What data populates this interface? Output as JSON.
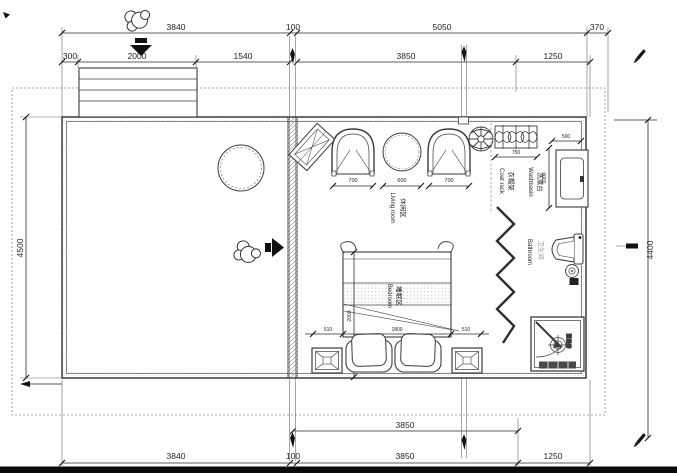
{
  "dimensions": {
    "top_row1": [
      "3840",
      "100",
      "5050",
      "370"
    ],
    "top_row2": [
      "300",
      "2000",
      "1540",
      "3850",
      "1250"
    ],
    "bottom_row1": [
      "3850"
    ],
    "bottom_row2": [
      "3840",
      "100",
      "3850",
      "1250"
    ],
    "left_height": "4500",
    "right_height": "4400",
    "living_row": [
      "700",
      "600",
      "700"
    ],
    "coat_rack_width": "750",
    "washbasin_width": "500",
    "washbasin_depth": "1000",
    "bed_row": [
      "510",
      "1800",
      "510"
    ],
    "bed_length": "2000"
  },
  "labels": {
    "living": {
      "zh": "休闲区",
      "en": "Living room"
    },
    "bedroom": {
      "zh": "睡眠区",
      "en": "Bedroom"
    },
    "washbasin": {
      "zh": "洗漱台",
      "en": "Washbasin"
    },
    "coat_rack": {
      "zh": "衣帽架",
      "en": "Coat rack"
    },
    "bathroom": {
      "zh": "卫生间",
      "en": "Bathroom"
    },
    "shower": {
      "zh": "淋浴房"
    }
  },
  "colors": {
    "line": "#3c3c3c",
    "text": "#1f1f1f",
    "gray_text": "#9b9b9b",
    "hatch": "#999999",
    "background": "#ffffff"
  }
}
